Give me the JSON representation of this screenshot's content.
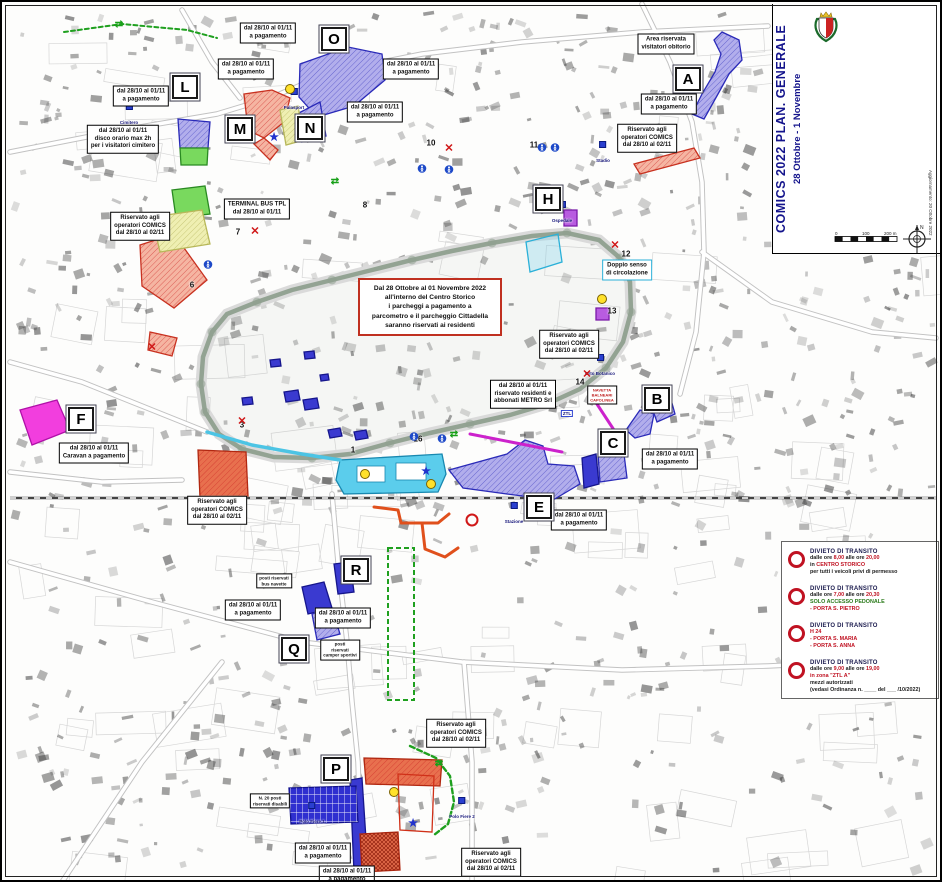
{
  "palette": {
    "zone_blue": "#b2aeec",
    "zone_blue_border": "#2a2ab8",
    "zone_red": "#f5b5a2",
    "zone_red_border": "#c03020",
    "zone_magenta": "#f23ede",
    "zone_green": "#79d95e",
    "zone_yellow": "#efefb2",
    "zone_purple": "#b85ce0",
    "zone_orange": "#dd8a4e",
    "zone_cyan": "#5bcdec",
    "route_orange": "#e0501c",
    "route_green": "#1fa01f",
    "new_jersey": "#cc22cc",
    "title_blue": "#14148c",
    "prohibition_red": "#c01222"
  },
  "header": {
    "city": "CITTA' DI LUCCA",
    "admin": "Amministrazione Comunale",
    "dept": "Settore Dip.5 - Lavori Pubblici, Urbanistica e Traffico",
    "unit": "U.O. 5.4 TRAFFICO",
    "legend_title": "Aree a Parcheggio Metro S.r.l."
  },
  "side_title": {
    "main": "COMICS 2022 PLAN. GENERALE",
    "dates": "28 Ottobre - 1 Novembre"
  },
  "update_note": "Aggiornamento: 20 Ottobre 2022",
  "legend": {
    "areas": [
      {
        "type": "blue",
        "label": "dal 28 Ottobre 2022 al 01 Novembre 2022 a pagamento (tranne ove diversamente indicato)"
      },
      {
        "type": "red",
        "label": "Riservato operatori COMICS dal 26 Ottobre 2022 al 02 Novembre 2022"
      },
      {
        "type": "magenta",
        "label": "dal 28 Ottobre 2022 al 01 Novembre 2022 a pagamento CARAVAN"
      },
      {
        "type": "green",
        "label": "dal 28 Ottobre al 1 Novembre - disco orario max 2h per i visitatori cimitero"
      },
      {
        "type": "yellow",
        "label": "dal 28 Ottobre 2022 al 01 Novembre 2022 riservato TERMINAL BUS TPL"
      },
      {
        "type": "purple",
        "label": "Riservato residenti e abbonati METRO Srl"
      },
      {
        "type": "orange",
        "label": "Area chiusa"
      }
    ],
    "symbols": [
      {
        "icon": "letter-box",
        "label": "Numerazione Parcheggi"
      },
      {
        "icon": "new-jersey",
        "label": "Posizionamento New Jersey"
      },
      {
        "icon": "access-vehicles",
        "label": "Accesso automezzi"
      },
      {
        "icon": "closure",
        "label": "Chiusura strada"
      },
      {
        "icon": "welcome",
        "label": "Welcome Desk"
      },
      {
        "icon": "taxi",
        "label": "TAXI"
      },
      {
        "icon": "access-ped",
        "label": "Accesso pedonale"
      },
      {
        "icon": "access-veh",
        "label": "Accesso ai veicoli"
      }
    ],
    "scale_labels": [
      "0",
      "100",
      "200 m"
    ]
  },
  "notice": {
    "lines": [
      "Dal 28 Ottobre al 01 Novembre 2022",
      "all'interno del Centro Storico",
      "i parcheggi a pagamento a",
      "parcometro e il parcheggio Cittadella",
      "saranno riservati ai residenti"
    ]
  },
  "transit": {
    "items": [
      {
        "title": "DIVIETO DI TRANSITO",
        "lines": [
          [
            {
              "t": "dalle ore ",
              "c": "k"
            },
            {
              "t": "8,00",
              "c": "r"
            },
            {
              "t": " alle ore ",
              "c": "k"
            },
            {
              "t": "20,00",
              "c": "r"
            }
          ],
          [
            {
              "t": "in ",
              "c": "k"
            },
            {
              "t": "CENTRO STORICO",
              "c": "r"
            }
          ],
          [
            {
              "t": "per tutti i veicoli privi di permesso",
              "c": "k"
            }
          ]
        ]
      },
      {
        "title": "DIVIETO DI TRANSITO",
        "lines": [
          [
            {
              "t": "dalle ore ",
              "c": "k"
            },
            {
              "t": "7,00",
              "c": "r"
            },
            {
              "t": " alle ore ",
              "c": "k"
            },
            {
              "t": "20,30",
              "c": "r"
            }
          ],
          [
            {
              "t": "SOLO ACCESSO PEDONALE",
              "c": "g"
            }
          ],
          [
            {
              "t": "- PORTA S. PIETRO",
              "c": "r"
            }
          ]
        ]
      },
      {
        "title": "DIVIETO DI TRANSITO",
        "lines": [
          [
            {
              "t": "H 24",
              "c": "r"
            }
          ],
          [
            {
              "t": "- PORTA S. MARIA",
              "c": "r"
            }
          ],
          [
            {
              "t": "- PORTA S. ANNA",
              "c": "r"
            }
          ]
        ]
      },
      {
        "title": "DIVIETO DI TRANSITO",
        "lines": [
          [
            {
              "t": "dalle ore ",
              "c": "k"
            },
            {
              "t": "9,00",
              "c": "r"
            },
            {
              "t": " alle ore ",
              "c": "k"
            },
            {
              "t": "19,00",
              "c": "r"
            }
          ],
          [
            {
              "t": "in zona \"ZTL A\"",
              "c": "r"
            }
          ],
          [
            {
              "t": "mezzi autorizzati",
              "c": "k"
            }
          ],
          [
            {
              "t": "(vedasi Ordinanza n. ____ del ___ /10/2022)",
              "c": "k"
            }
          ]
        ]
      }
    ]
  },
  "markers": {
    "letters": [
      {
        "id": "A",
        "x": 686,
        "y": 77
      },
      {
        "id": "B",
        "x": 655,
        "y": 397
      },
      {
        "id": "C",
        "x": 611,
        "y": 441
      },
      {
        "id": "E",
        "x": 537,
        "y": 505
      },
      {
        "id": "F",
        "x": 79,
        "y": 417
      },
      {
        "id": "H",
        "x": 546,
        "y": 197
      },
      {
        "id": "L",
        "x": 183,
        "y": 85
      },
      {
        "id": "M",
        "x": 238,
        "y": 127
      },
      {
        "id": "N",
        "x": 308,
        "y": 126
      },
      {
        "id": "O",
        "x": 332,
        "y": 37
      },
      {
        "id": "P",
        "x": 334,
        "y": 767
      },
      {
        "id": "Q",
        "x": 292,
        "y": 647
      },
      {
        "id": "R",
        "x": 354,
        "y": 568
      }
    ]
  },
  "numbers": [
    {
      "n": "1",
      "x": 351,
      "y": 448
    },
    {
      "n": "3",
      "x": 240,
      "y": 423
    },
    {
      "n": "6",
      "x": 190,
      "y": 283
    },
    {
      "n": "7",
      "x": 236,
      "y": 230
    },
    {
      "n": "8",
      "x": 363,
      "y": 203
    },
    {
      "n": "10",
      "x": 429,
      "y": 141
    },
    {
      "n": "11",
      "x": 532,
      "y": 143
    },
    {
      "n": "12",
      "x": 624,
      "y": 252
    },
    {
      "n": "13",
      "x": 610,
      "y": 309
    },
    {
      "n": "14",
      "x": 578,
      "y": 380
    },
    {
      "n": "16",
      "x": 416,
      "y": 437
    }
  ],
  "boxes": [
    {
      "x": 266,
      "y": 31,
      "style": "std",
      "lines": [
        "dal 28/10 al 01/11",
        "a pagamento"
      ]
    },
    {
      "x": 409,
      "y": 67,
      "style": "std",
      "lines": [
        "dal 28/10 al 01/11",
        "a pagamento"
      ]
    },
    {
      "x": 244,
      "y": 67,
      "style": "std",
      "lines": [
        "dal 28/10 al 01/11",
        "a pagamento"
      ]
    },
    {
      "x": 139,
      "y": 94,
      "style": "std",
      "lines": [
        "dal 28/10 al 01/11",
        "a pagamento"
      ]
    },
    {
      "x": 121,
      "y": 137,
      "style": "std",
      "lines": [
        "dal 28/10 al 01/11",
        "disco orario max 2h",
        "per i visitatori cimitero"
      ]
    },
    {
      "x": 373,
      "y": 110,
      "style": "std",
      "lines": [
        "dal 28/10 al 01/11",
        "a pagamento"
      ]
    },
    {
      "x": 138,
      "y": 224,
      "style": "std",
      "lines": [
        "Riservato agli",
        "operatori COMICS",
        "dal 28/10 al 02/11"
      ]
    },
    {
      "x": 255,
      "y": 207,
      "style": "std",
      "lines": [
        "TERMINAL BUS TPL",
        "dal 28/10 al 01/11"
      ]
    },
    {
      "x": 664,
      "y": 42,
      "style": "std",
      "lines": [
        "Area riservata",
        "visitatori obitorio"
      ]
    },
    {
      "x": 667,
      "y": 102,
      "style": "std",
      "lines": [
        "dal 28/10 al 01/11",
        "a pagamento"
      ]
    },
    {
      "x": 645,
      "y": 136,
      "style": "std",
      "lines": [
        "Riservato agli",
        "operatori COMICS",
        "dal 28/10 al 02/11"
      ]
    },
    {
      "x": 567,
      "y": 342,
      "style": "std",
      "lines": [
        "Riservato agli",
        "operatori COMICS",
        "dal 28/10 al 02/11"
      ]
    },
    {
      "x": 521,
      "y": 392,
      "style": "std",
      "lines": [
        "dal 28/10 al 01/11",
        "riservato residenti e",
        "abbonati METRO Srl"
      ]
    },
    {
      "x": 668,
      "y": 457,
      "style": "std",
      "lines": [
        "dal 28/10 al 01/11",
        "a pagamento"
      ]
    },
    {
      "x": 577,
      "y": 518,
      "style": "std",
      "lines": [
        "dal 28/10 al 01/11",
        "a pagamento"
      ]
    },
    {
      "x": 625,
      "y": 268,
      "style": "cyan",
      "lines": [
        "Doppio senso",
        "di circolazione"
      ]
    },
    {
      "x": 215,
      "y": 508,
      "style": "std",
      "lines": [
        "Riservato agli",
        "operatori COMICS",
        "dal 28/10 al 02/11"
      ]
    },
    {
      "x": 251,
      "y": 608,
      "style": "std",
      "lines": [
        "dal 28/10 al 01/11",
        "a pagamento"
      ]
    },
    {
      "x": 341,
      "y": 616,
      "style": "std",
      "lines": [
        "dal 28/10 al 01/11",
        "a pagamento"
      ]
    },
    {
      "x": 454,
      "y": 731,
      "style": "std",
      "lines": [
        "Riservato agli",
        "operatori COMICS",
        "dal 28/10 al 02/11"
      ]
    },
    {
      "x": 321,
      "y": 851,
      "style": "std",
      "lines": [
        "dal 28/10 al 01/11",
        "a pagamento"
      ]
    },
    {
      "x": 489,
      "y": 860,
      "style": "std",
      "lines": [
        "Riservato agli",
        "operatori COMICS",
        "dal 28/10 al 02/11"
      ]
    },
    {
      "x": 92,
      "y": 451,
      "style": "std",
      "lines": [
        "dal 28/10 al 01/11",
        "Caravan a pagamento"
      ]
    },
    {
      "x": 272,
      "y": 579,
      "style": "tiny",
      "lines": [
        "posti riservati",
        "bus navette"
      ]
    },
    {
      "x": 268,
      "y": 799,
      "style": "tiny",
      "lines": [
        "N. 20 posti",
        "riservati disabili"
      ]
    },
    {
      "x": 600,
      "y": 393,
      "style": "tinyred",
      "lines": [
        "NAVETTA",
        "BALNEARI",
        "CAPOLINEA"
      ]
    },
    {
      "x": 338,
      "y": 648,
      "style": "tiny",
      "lines": [
        "posti",
        "riservati",
        "camper sportivi"
      ]
    },
    {
      "x": 345,
      "y": 874,
      "style": "std",
      "lines": [
        "dal 28/10 al 01/11",
        "a pagamento"
      ]
    }
  ],
  "map_labels": [
    {
      "t": "Cimitero",
      "x": 127,
      "y": 101
    },
    {
      "t": "Palasport",
      "x": 292,
      "y": 86
    },
    {
      "t": "Stadio",
      "x": 601,
      "y": 139
    },
    {
      "t": "Ospedale",
      "x": 560,
      "y": 199
    },
    {
      "t": "Orto Botanico",
      "x": 598,
      "y": 352
    },
    {
      "t": "Stazione",
      "x": 512,
      "y": 500
    },
    {
      "t": "Polo Fiere 1",
      "x": 310,
      "y": 800
    },
    {
      "t": "Polo Fiere 2",
      "x": 460,
      "y": 795
    },
    {
      "t": "ZTL",
      "x": 565,
      "y": 400,
      "noicon": true
    }
  ],
  "map_icons": {
    "welcome": [
      [
        288,
        87
      ],
      [
        363,
        472
      ],
      [
        429,
        482
      ],
      [
        392,
        790
      ],
      [
        600,
        297
      ]
    ],
    "taxi": [
      [
        272,
        136
      ],
      [
        424,
        470
      ],
      [
        411,
        822
      ]
    ],
    "ped": [
      [
        420,
        167
      ],
      [
        447,
        168
      ],
      [
        540,
        146
      ],
      [
        553,
        146
      ],
      [
        206,
        263
      ],
      [
        412,
        435
      ],
      [
        440,
        437
      ]
    ],
    "arrows": [
      [
        333,
        180
      ],
      [
        452,
        433
      ],
      [
        437,
        762
      ],
      [
        117,
        23
      ]
    ],
    "closure": [
      [
        253,
        230
      ],
      [
        447,
        147
      ],
      [
        613,
        244
      ],
      [
        585,
        373
      ],
      [
        240,
        420
      ],
      [
        150,
        346
      ]
    ],
    "rings": [
      [
        470,
        518
      ]
    ]
  }
}
